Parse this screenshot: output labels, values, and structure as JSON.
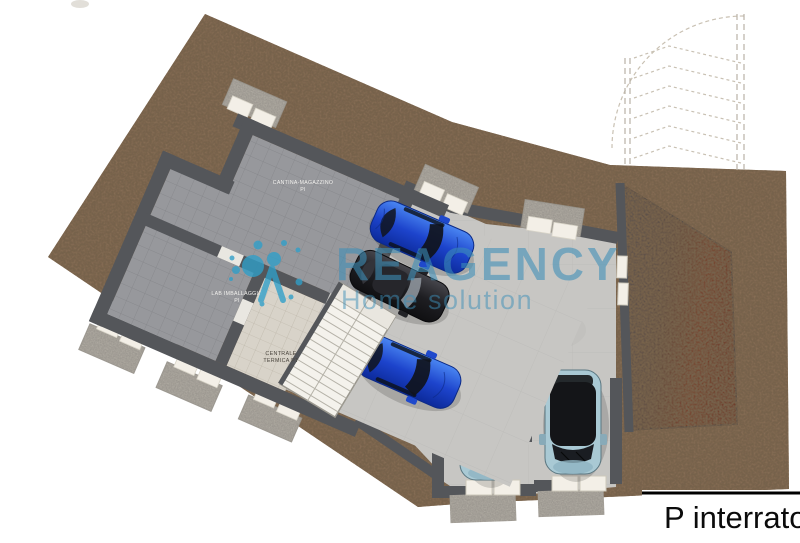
{
  "floor_plate": {
    "label": "P interrato"
  },
  "watermark": {
    "brand": "REAGENCY",
    "tagline": "Home solution"
  },
  "rooms": {
    "cantina_magazzino": {
      "line1": "CANTINA-MAGAZZINO",
      "line2": "PI"
    },
    "lab_imballaggio": {
      "line1": "LAB IMBALLAGGIO",
      "line2": "PI"
    },
    "centrale_termica": {
      "line1": "CENTRALE",
      "line2": "TERMICA PT"
    }
  },
  "palette": {
    "terrain": "#8b7158",
    "garage_floor": "#c7c6c3",
    "cellar_floor": "#97989c",
    "boiler_floor": "#d8d3c9",
    "walls": "#54565a",
    "gravel": "#b8b3a9",
    "light_well_block": "#f3efe7",
    "ramp_red": "#6e2d1a",
    "stairs": "#f4f2ec",
    "watermark_blue": "#3d8fb8",
    "logo_blue": "#2f9fc9",
    "car_blue": "#1e4ad0",
    "car_teal": "#a9c9d4",
    "car_black": "#141416"
  },
  "cars": [
    {
      "id": "car-blue-1",
      "color": "blue",
      "location": "garage upper"
    },
    {
      "id": "car-black",
      "color": "black",
      "location": "garage middle"
    },
    {
      "id": "car-blue-2",
      "color": "blue",
      "location": "garage lower"
    },
    {
      "id": "car-teal-left",
      "color": "teal",
      "location": "parking bay left"
    },
    {
      "id": "car-teal-right",
      "color": "teal",
      "location": "parking bay right"
    }
  ]
}
